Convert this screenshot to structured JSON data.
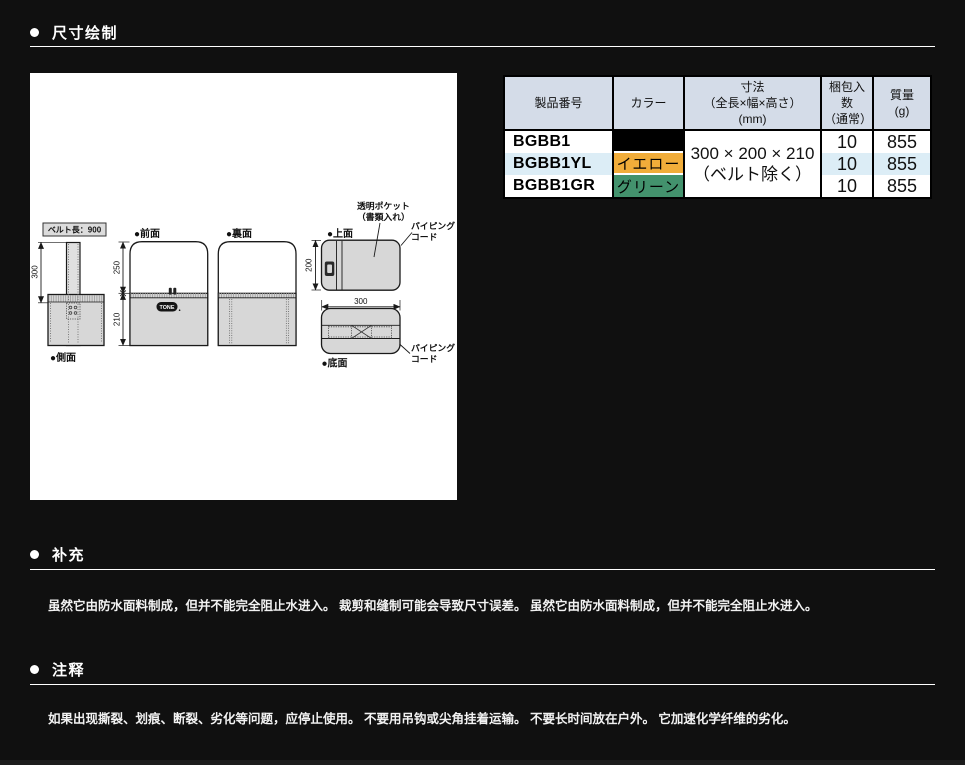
{
  "sections": {
    "dimension_drawing": {
      "title": "尺寸绘制"
    },
    "supplement": {
      "title": "补充",
      "body": "虽然它由防水面料制成，但并不能完全阻止水进入。 裁剪和缝制可能会导致尺寸误差。 虽然它由防水面料制成，但并不能完全阻止水进入。"
    },
    "notes": {
      "title": "注释",
      "body": "如果出现撕裂、划痕、断裂、劣化等问题，应停止使用。 不要用吊钩或尖角挂着运输。 不要长时间放在户外。 它加速化学纤维的劣化。"
    }
  },
  "drawing": {
    "belt_length_label": "ベルト長：900",
    "view_labels": {
      "side": "●側面",
      "front": "●前面",
      "back": "●裏面",
      "top": "●上面",
      "bottom": "●底面"
    },
    "dimensions": {
      "side_height": "300",
      "front_upper": "250",
      "front_lower": "210",
      "top_depth": "200",
      "top_width": "300"
    },
    "annotations": {
      "clear_pocket_line1": "透明ポケット",
      "clear_pocket_line2": "（書類入れ）",
      "piping_top_line1": "パイピング",
      "piping_top_line2": "コード",
      "piping_bottom_line1": "パイピング",
      "piping_bottom_line2": "コード"
    },
    "brand_logo": "TONE"
  },
  "spec_table": {
    "headers": {
      "product_no": "製品番号",
      "color": "カラー",
      "size_line1": "寸法",
      "size_line2": "（全長×幅×高さ）",
      "size_line3": "(mm)",
      "pack_line1": "梱包入数",
      "pack_line2": "（通常）",
      "mass_line1": "質量",
      "mass_line2": "(g)"
    },
    "size_value_line1": "300 × 200 × 210",
    "size_value_line2": "（ベルト除く）",
    "rows": [
      {
        "product_no": "BGBB1",
        "color_name": "ブラック",
        "color_bg": "#000000",
        "color_text": "#ffffff",
        "pack_qty": "10",
        "mass": "855",
        "row_bg": "#ffffff"
      },
      {
        "product_no": "BGBB1YL",
        "color_name": "イエロー",
        "color_bg": "#f1ad3a",
        "color_text": "#ffffff",
        "pack_qty": "10",
        "mass": "855",
        "row_bg": "#dcedf6"
      },
      {
        "product_no": "BGBB1GR",
        "color_name": "グリーン",
        "color_bg": "#43926d",
        "color_text": "#ffffff",
        "pack_qty": "10",
        "mass": "855",
        "row_bg": "#ffffff"
      }
    ],
    "colors": {
      "header_bg": "#d4dce8",
      "row_alt_bg": "#dcedf6",
      "border": "#000000"
    }
  },
  "theme": {
    "page_bg": "#101010",
    "panel_bg": "#ffffff",
    "text": "#ffffff"
  }
}
